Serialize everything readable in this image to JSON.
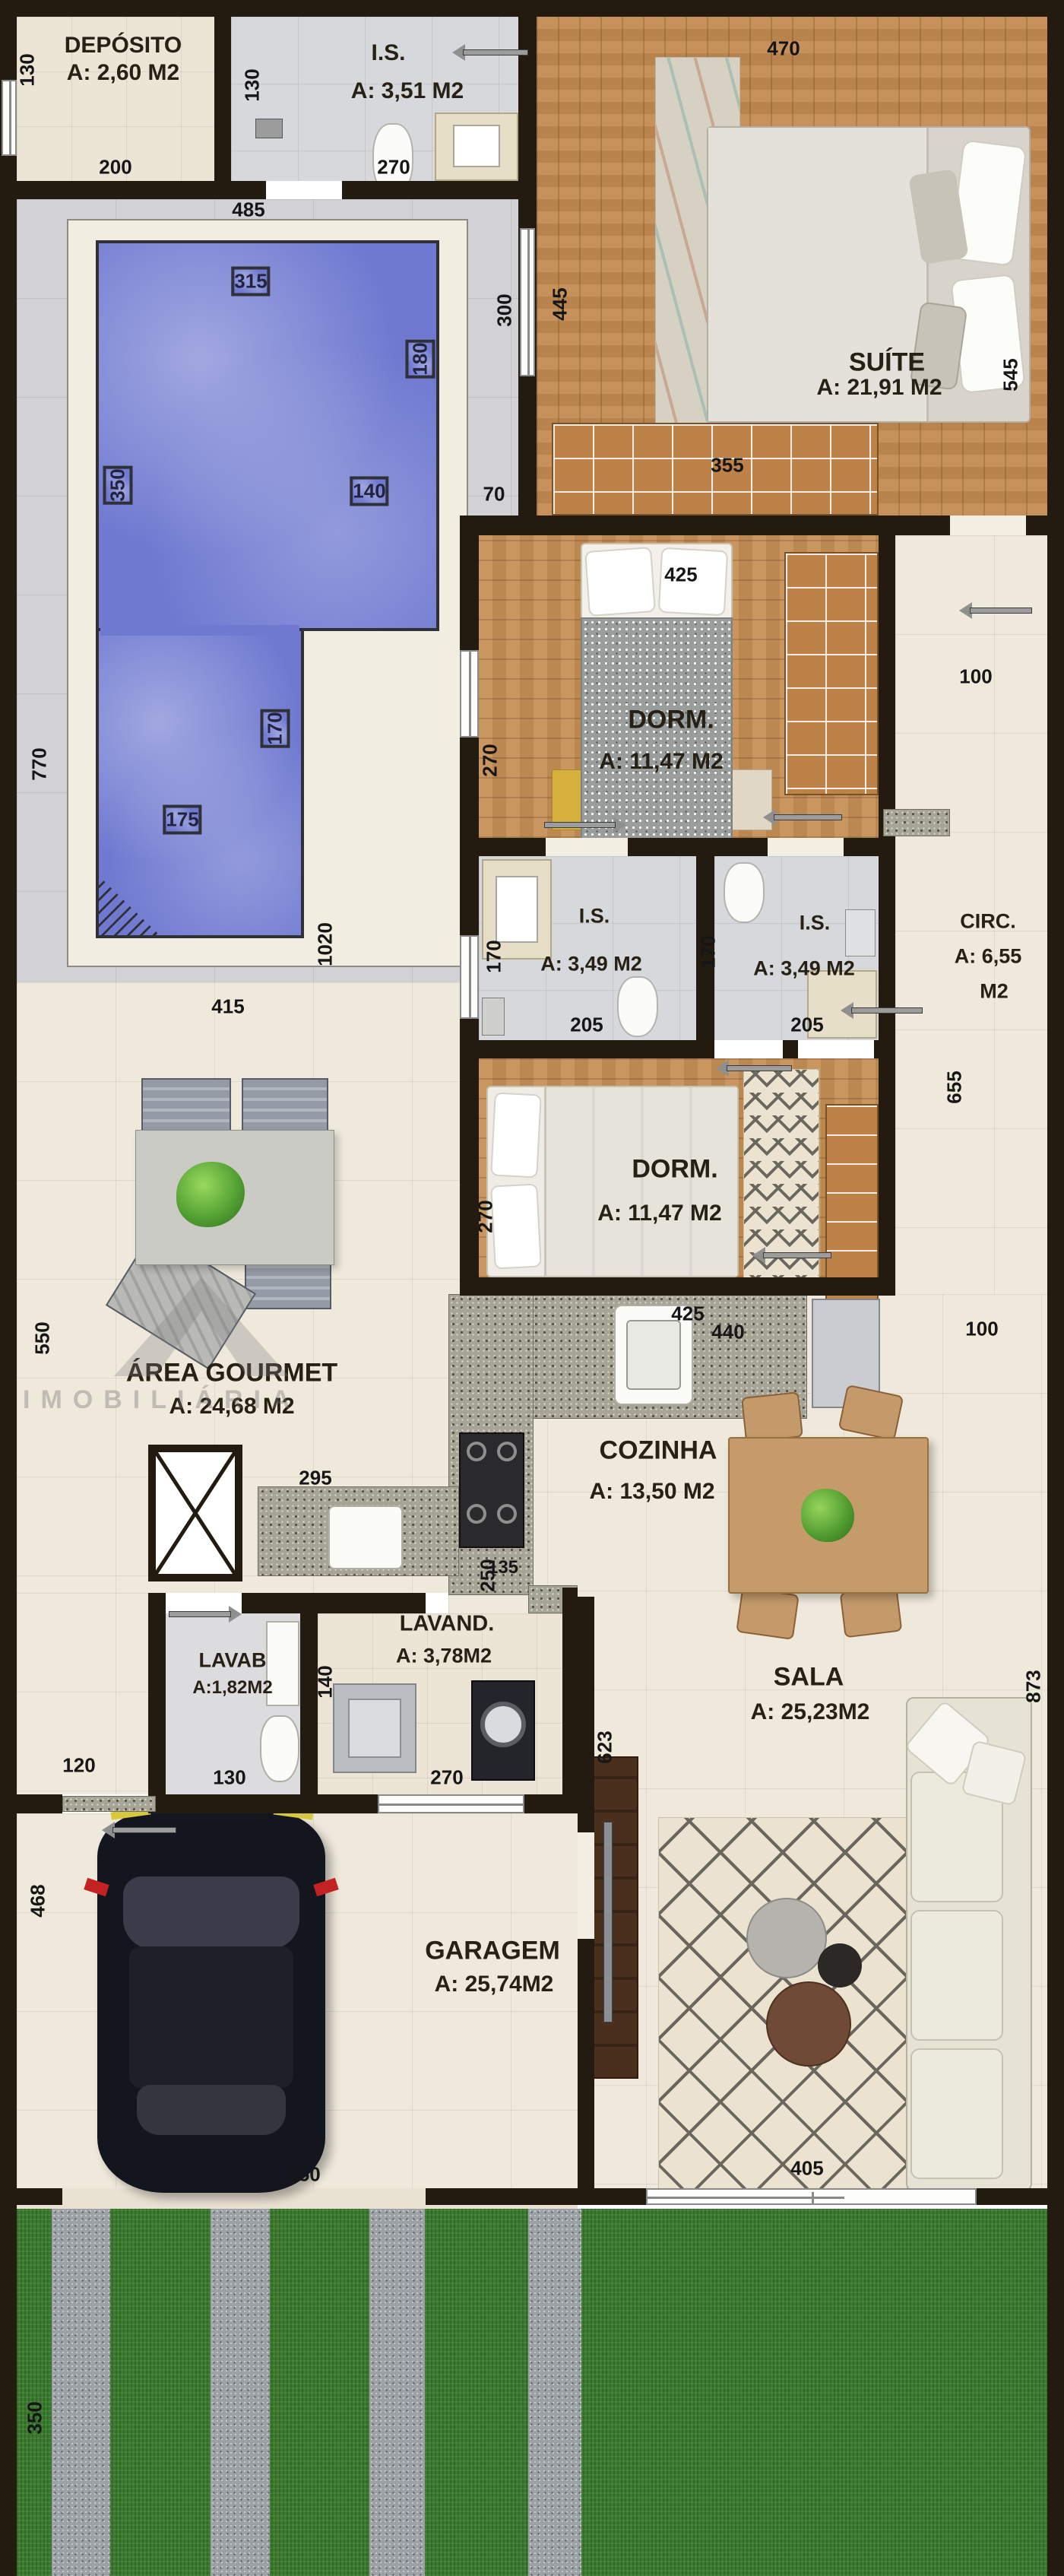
{
  "plan": {
    "rooms": {
      "deposito": {
        "name": "DEPÓSITO",
        "area": "A: 2,60 M2"
      },
      "is_top": {
        "name": "I.S.",
        "area": "A: 3,51 M2"
      },
      "suite": {
        "name": "SUÍTE",
        "area": "A: 21,91 M2"
      },
      "dorm1": {
        "name": "DORM.",
        "area": "A: 11,47 M2"
      },
      "is1": {
        "name": "I.S.",
        "area": "A: 3,49 M2"
      },
      "is2": {
        "name": "I.S.",
        "area": "A: 3,49 M2"
      },
      "circ": {
        "name": "CIRC.",
        "area": "A: 6,55",
        "area2": "M2"
      },
      "dorm2": {
        "name": "DORM.",
        "area": "A: 11,47 M2"
      },
      "gourmet": {
        "name": "ÁREA GOURMET",
        "area": "A: 24,68 M2"
      },
      "cozinha": {
        "name": "COZINHA",
        "area": "A: 13,50 M2"
      },
      "lavab": {
        "name": "LAVAB",
        "area": "A:1,82M2"
      },
      "lavand": {
        "name": "LAVAND.",
        "area": "A: 3,78M2"
      },
      "sala": {
        "name": "SALA",
        "area": "A: 25,23M2"
      },
      "garagem": {
        "name": "GARAGEM",
        "area": "A: 25,74M2"
      }
    },
    "dims": {
      "d130_dep": "130",
      "d200": "200",
      "d130_is": "130",
      "d270_is": "270",
      "d485": "485",
      "d470": "470",
      "d445": "445",
      "d545": "545",
      "d355": "355",
      "d70": "70",
      "d300": "300",
      "d315": "315",
      "d180": "180",
      "d350_pool": "350",
      "d140": "140",
      "d170_pool": "170",
      "d175": "175",
      "d770": "770",
      "d1020": "1020",
      "d415": "415",
      "d550_gourmet": "550",
      "d425_dorm1": "425",
      "d270_dorm1": "270",
      "d100_circ": "100",
      "d655": "655",
      "d170_is1": "170",
      "d205_is1": "205",
      "d170_is2": "170",
      "d205_is2": "205",
      "d270_dorm2": "270",
      "d425_dorm2": "425",
      "d440": "440",
      "d250": "250",
      "d100_coz": "100",
      "d135": "135",
      "d295": "295",
      "d120": "120",
      "d130_lavab": "130",
      "d140_lavand": "140",
      "d270_lavand": "270",
      "d623": "623",
      "d873": "873",
      "d468": "468",
      "d550_gar": "550",
      "d405": "405",
      "d350_front": "350"
    },
    "watermark": "IMOBILIÁRIA",
    "colors": {
      "wall": "#231a10",
      "pool": "#6f79d0",
      "grass": "#3a7b2d",
      "wood": "#c28a50"
    }
  }
}
